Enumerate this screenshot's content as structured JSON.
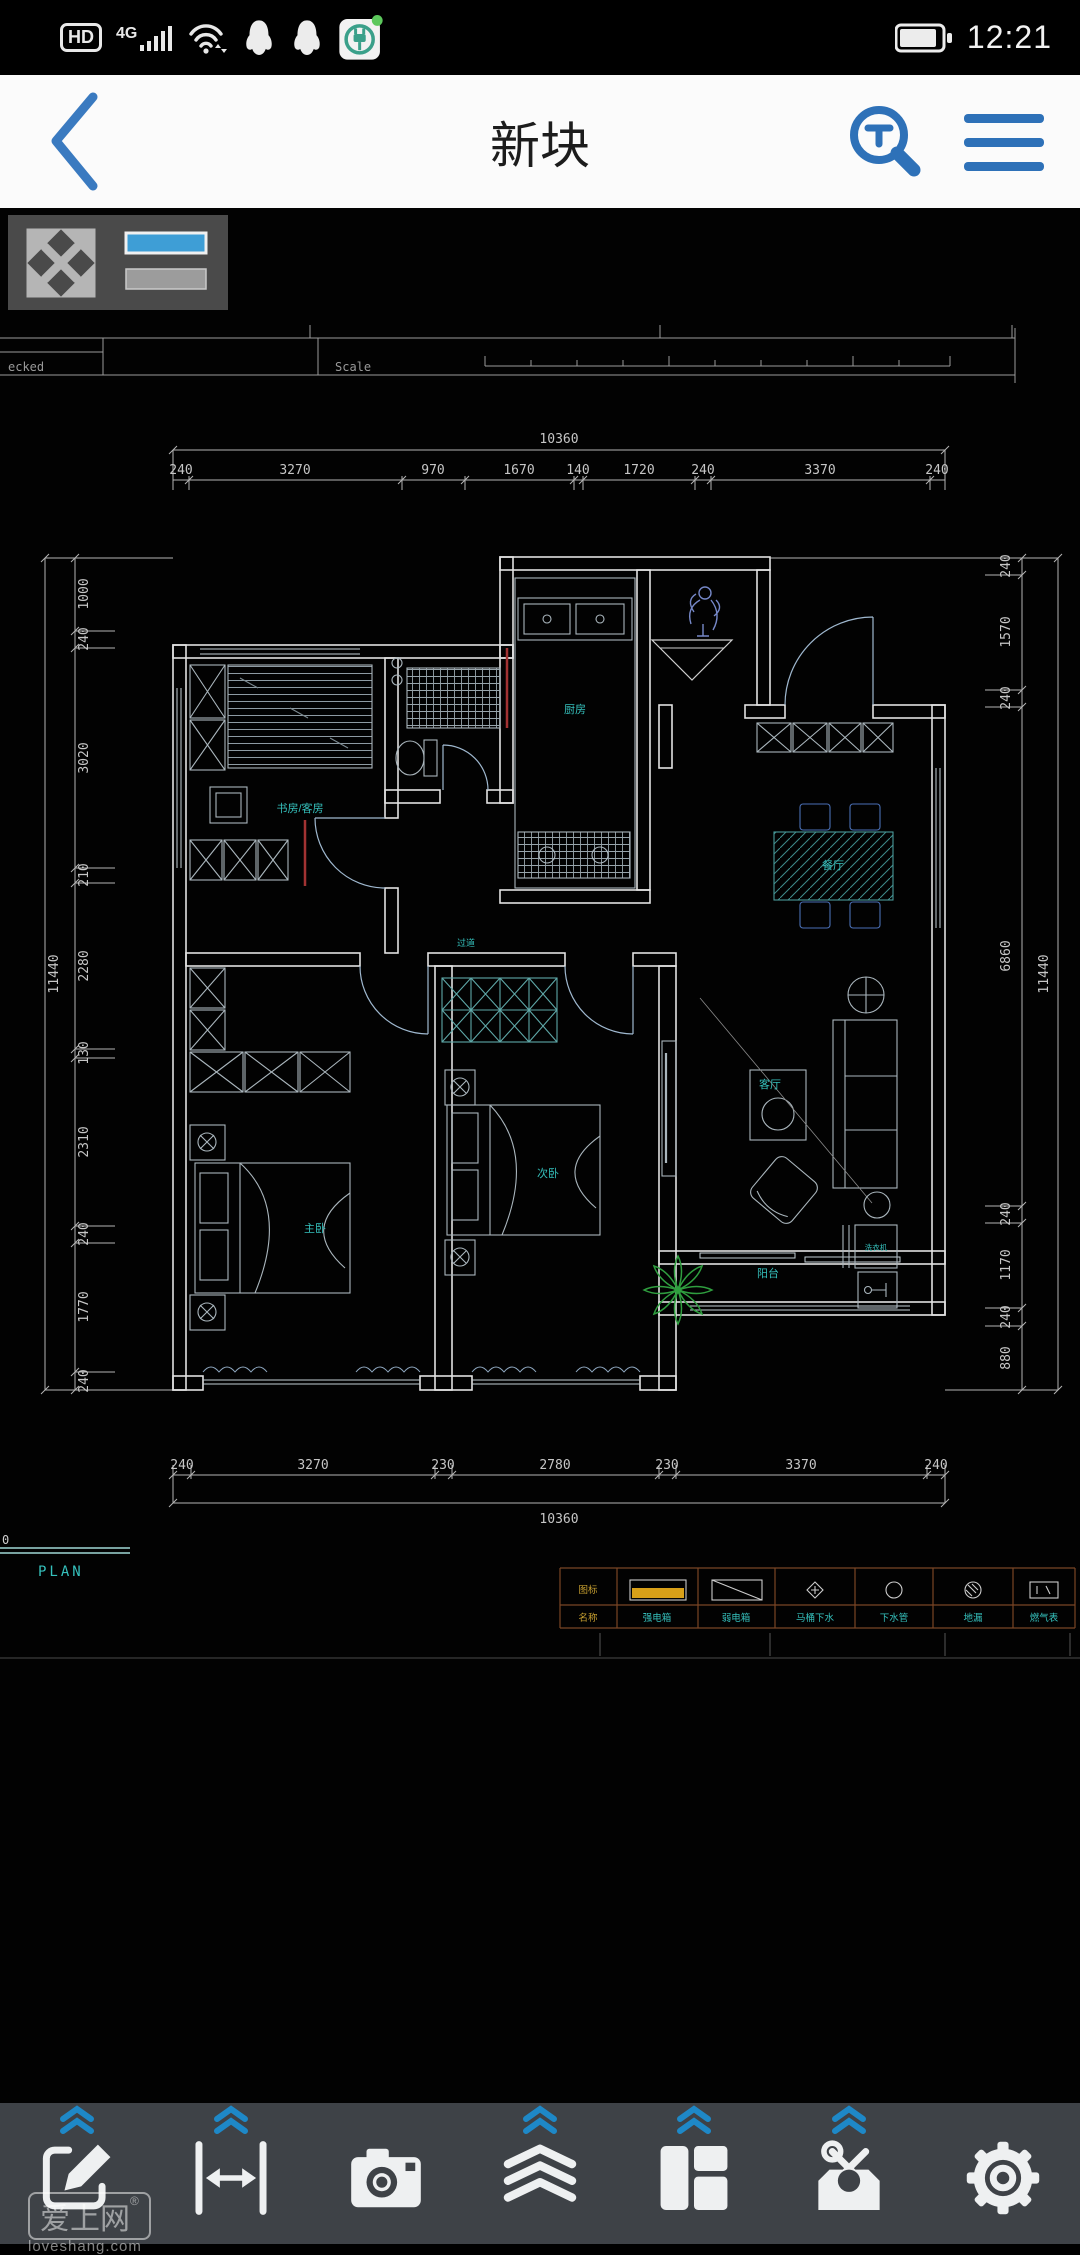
{
  "status_bar": {
    "hd": "HD",
    "network": "4G",
    "time": "12:21"
  },
  "nav": {
    "title": "新块"
  },
  "colors": {
    "accent": "#2e71b8",
    "cad_cyan": "#35c0bc",
    "legend_yellow": "#d8a018",
    "chevron_blue": "#1e88c7",
    "wall": "#e2e2e2"
  },
  "canvas": {
    "title_block": {
      "checked_label": "ecked",
      "scale_label": "Scale"
    },
    "plan_caption": "PLAN",
    "left_edge_number": "0",
    "dims": {
      "top": {
        "total": "10360",
        "segments": [
          "240",
          "3270",
          "970",
          "1670",
          "140",
          "1720",
          "240",
          "3370",
          "240"
        ]
      },
      "bottom": {
        "total": "10360",
        "segments": [
          "240",
          "3270",
          "230",
          "2780",
          "230",
          "3370",
          "240"
        ]
      },
      "left": {
        "total": "11440",
        "segments": [
          "1000",
          "240",
          "3020",
          "210",
          "2280",
          "130",
          "2310",
          "240",
          "1770",
          "240"
        ]
      },
      "right": {
        "total": "11440",
        "segments": [
          "240",
          "1570",
          "240",
          "6860",
          "240",
          "1170",
          "240",
          "880"
        ]
      }
    },
    "rooms": {
      "study": "书房/客房",
      "kitchen": "厨房",
      "corridor": "过道",
      "dining": "餐厅",
      "living": "客厅",
      "balcony": "阳台",
      "master": "主卧",
      "second": "次卧",
      "washer": "洗衣机"
    },
    "legend": {
      "headers": {
        "icon": "图标",
        "name": "名称"
      },
      "items": [
        {
          "name": "强电箱"
        },
        {
          "name": "弱电箱"
        },
        {
          "name": "马桶下水"
        },
        {
          "name": "下水管"
        },
        {
          "name": "地漏"
        },
        {
          "name": "燃气表"
        }
      ]
    }
  },
  "watermark": {
    "brand": "爱上网",
    "reg": "®",
    "domain": "loveshang.com"
  },
  "toolbar": {
    "icons": [
      "edit",
      "measure",
      "camera",
      "layers",
      "layout",
      "toolbox",
      "settings"
    ]
  }
}
